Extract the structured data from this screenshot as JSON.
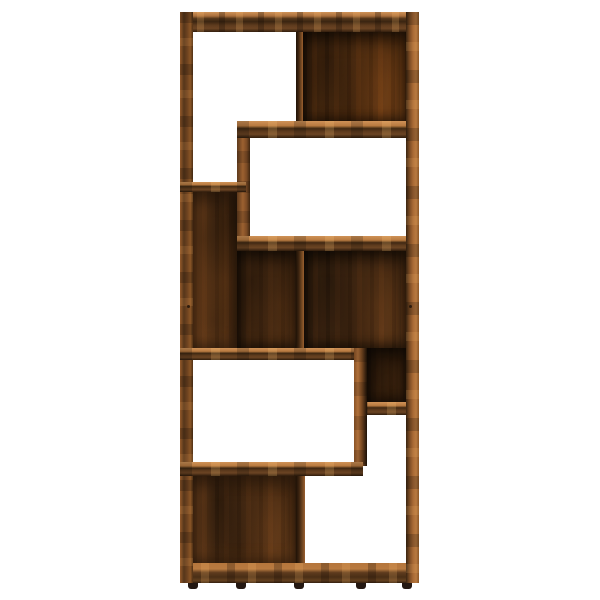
{
  "scene": {
    "type": "product-photo",
    "subject": "Tall asymmetric open bookshelf room-divider shelf unit in smoked oak wood finish, front view, standing on five small black feet, centered on a plain white background",
    "background_color": "#ffffff"
  },
  "palette": {
    "background": "#ffffff",
    "wood_highlight": "#cf9257",
    "wood_light": "#b87a40",
    "wood_mid": "#8a5628",
    "wood_dark": "#4e3015",
    "wood_darker": "#2b1a0b",
    "panel_base": "#4a2e16",
    "panel_light_streak": "#a5652c",
    "foot": "#241812"
  },
  "structure": {
    "open_compartments": 4,
    "backed_compartments": 4,
    "shelf_boards": 6,
    "vertical_dividers": 4,
    "feet": 5
  }
}
